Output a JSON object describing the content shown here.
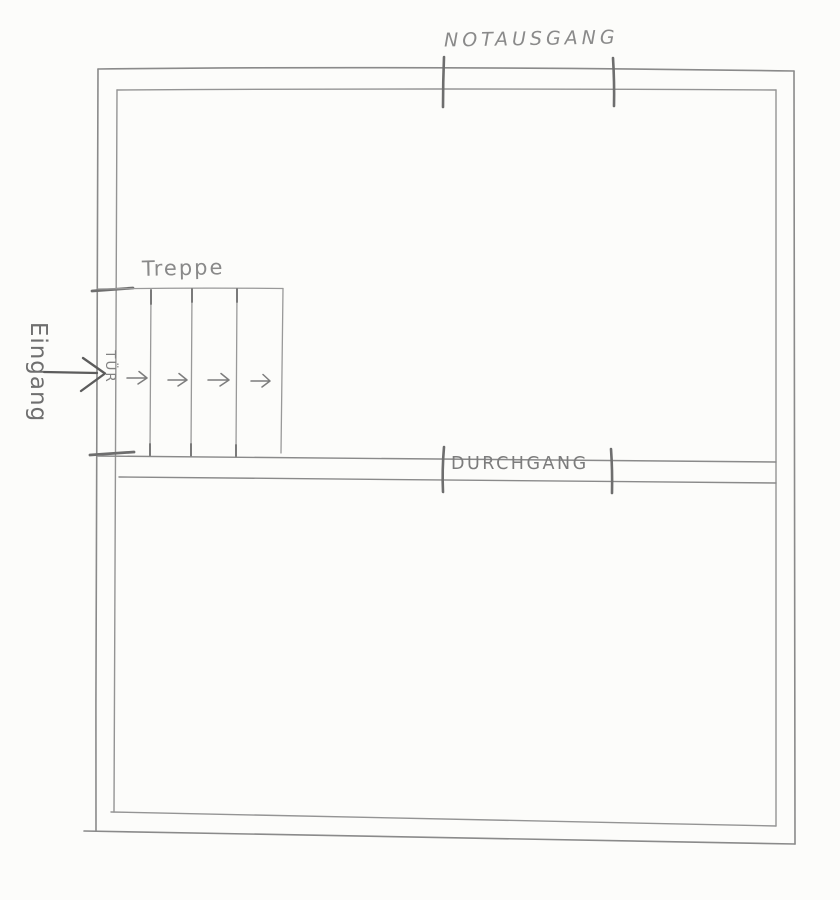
{
  "sketch": {
    "kind": "hand-drawn floor plan",
    "language": "German"
  },
  "labels": {
    "emergency_exit": "NOTAUSGANG",
    "stairs": "Treppe",
    "door": "TÜR",
    "entrance": "Eingang",
    "passage": "DURCHGANG"
  },
  "symbols": {
    "step_arrow": "→",
    "step_arrow_count": 4,
    "step_arrow_direction": "right",
    "entrance_arrow": "→",
    "entrance_arrow_direction": "right"
  },
  "colors": {
    "paper": "#fcfcfa",
    "pencil_light": "#999999",
    "pencil": "#8a8a8a",
    "pencil_dark": "#6e6e6e",
    "label_text": "#7f7f7f"
  }
}
